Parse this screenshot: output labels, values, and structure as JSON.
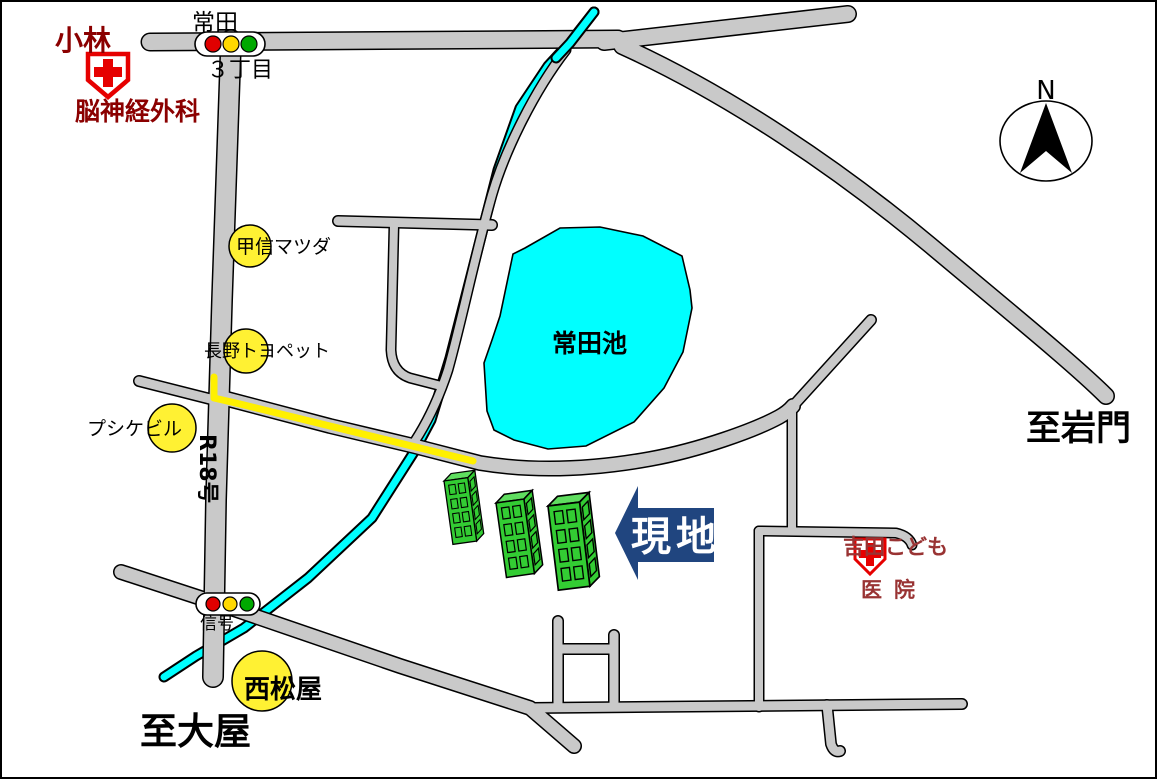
{
  "map": {
    "landmarks": {
      "kobayashi_line1": "小林",
      "kobayashi_line2": "脳神経外科",
      "mazda": "甲信マツダ",
      "toyopet": "長野トヨペット",
      "psyche": "プシケビル",
      "nishimatsuya": "西松屋",
      "pond": "常田池",
      "yoshida_line1": "吉田こども",
      "yoshida_line2": "医院"
    },
    "roads": {
      "r18": "R18号",
      "tokida_signal": "常田",
      "chome": "３丁目",
      "signal": "信号",
      "to_iwakado": "至岩門",
      "to_oya": "至大屋"
    },
    "site": {
      "arrow_label": "現地",
      "building_count": 3
    },
    "compass": {
      "north": "N"
    },
    "colors": {
      "road_fill": "#c9c9c9",
      "water_cyan": "#00ffff",
      "route_highlight_yellow": "#fff000",
      "landmark_circle_yellow": "#fff133",
      "site_arrow_blue": "#20457f",
      "building_green": "#33cc33",
      "hospital_cross_red": "#e60000",
      "dark_red_text": "#8b0000",
      "clinic_text_red": "#993333"
    }
  }
}
